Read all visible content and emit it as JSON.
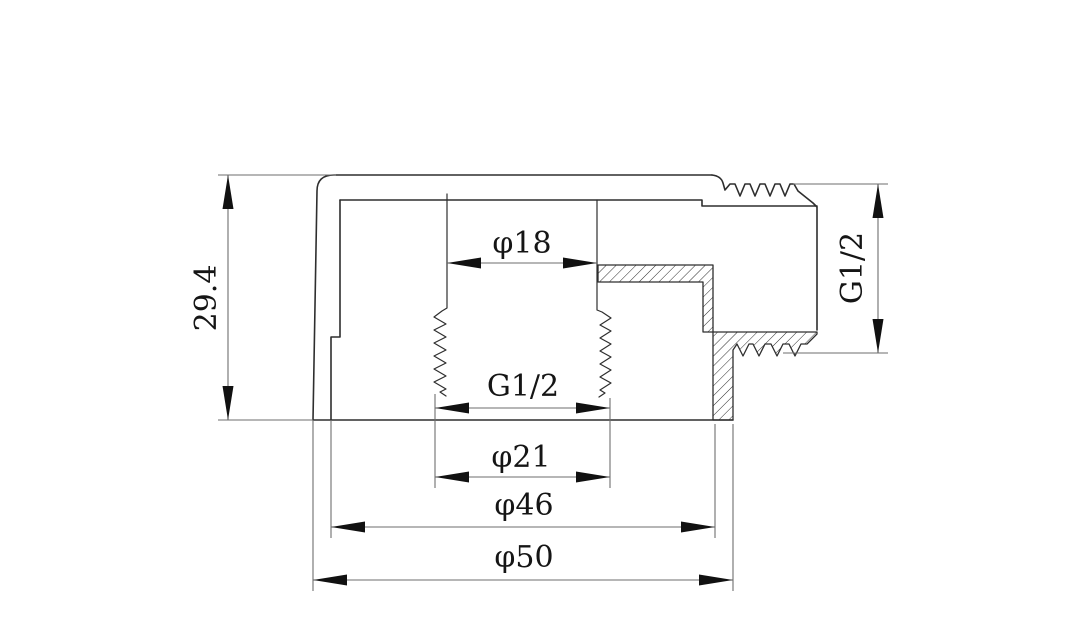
{
  "drawing": {
    "background": "#ffffff",
    "line_color": "#2e2e2e",
    "dimension_line_color": "#6e6e6e",
    "text_color": "#151515",
    "dimensions": {
      "height": "29.4",
      "bore_dia": "φ18",
      "female_thread": "G1/2",
      "thread_dia": "φ21",
      "inner_dia": "φ46",
      "outer_dia": "φ50",
      "male_thread": "G1/2"
    }
  }
}
